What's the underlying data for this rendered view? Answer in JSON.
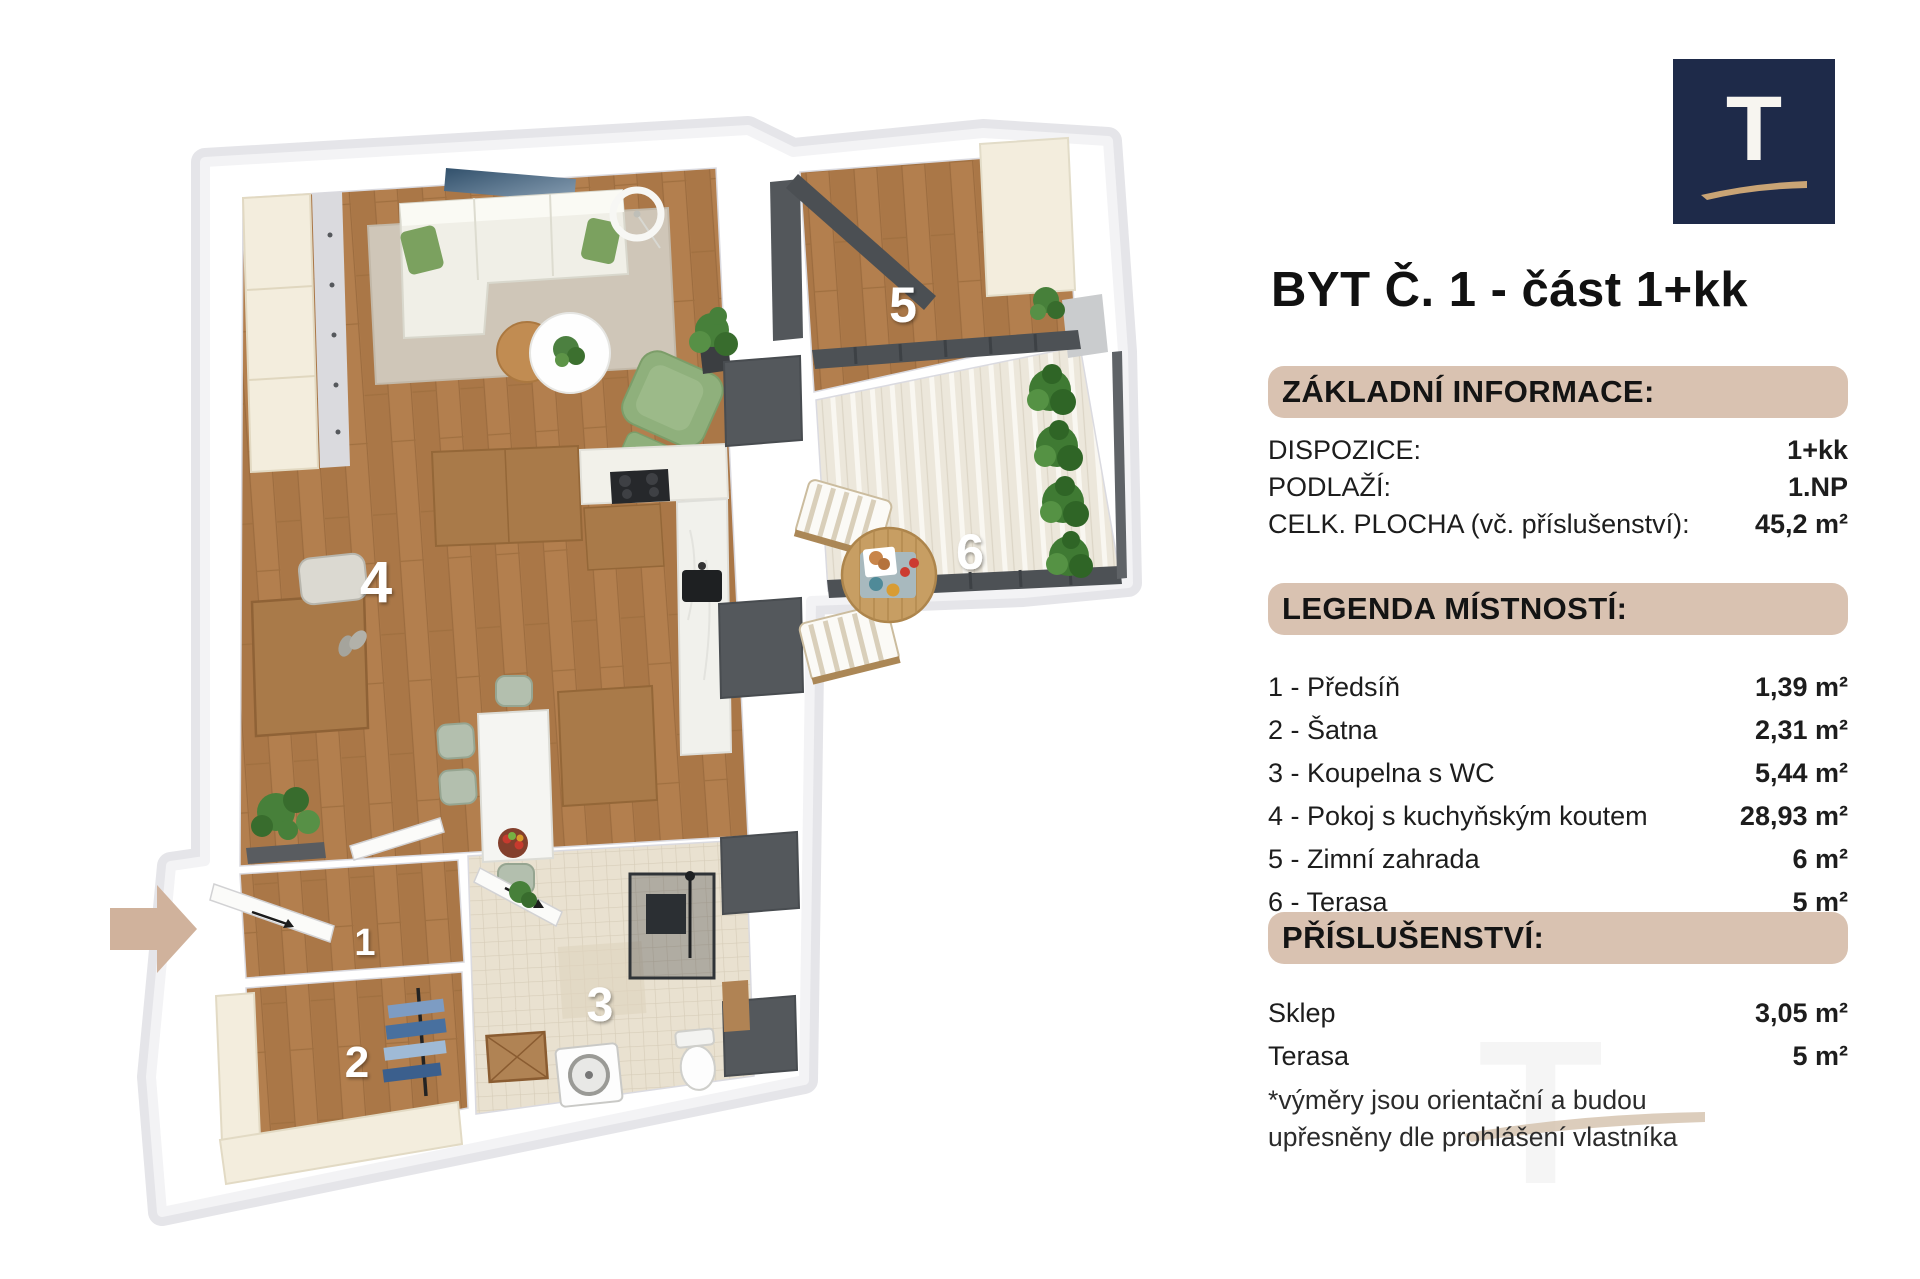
{
  "title": "BYT Č. 1 - část 1+kk",
  "logo": {
    "letter": "T"
  },
  "basic_info": {
    "heading": "ZÁKLADNÍ INFORMACE:",
    "rows": [
      {
        "label": "DISPOZICE:",
        "value": "1+kk"
      },
      {
        "label": "PODLAŽÍ:",
        "value": "1.NP"
      },
      {
        "label": "CELK. PLOCHA (vč. příslušenství):",
        "value": "45,2 m²"
      }
    ]
  },
  "legend": {
    "heading": "LEGENDA MÍSTNOSTÍ:",
    "rows": [
      {
        "label": "1 - Předsíň",
        "value": "1,39 m²"
      },
      {
        "label": "2 - Šatna",
        "value": "2,31 m²"
      },
      {
        "label": "3 - Koupelna s WC",
        "value": "5,44 m²"
      },
      {
        "label": "4 - Pokoj s kuchyňským koutem",
        "value": "28,93 m²"
      },
      {
        "label": "5 - Zimní zahrada",
        "value": "6 m²"
      },
      {
        "label": "6 - Terasa",
        "value": "5 m²"
      }
    ]
  },
  "accessories": {
    "heading": "PŘÍSLUŠENSTVÍ:",
    "rows": [
      {
        "label": "Sklep",
        "value": "3,05 m²"
      },
      {
        "label": "Terasa",
        "value": "5 m²"
      }
    ],
    "note_line1": "*výměry jsou orientační a budou",
    "note_line2": "upřesněny dle prohlášení vlastníka"
  },
  "plan": {
    "room_numbers": [
      "1",
      "2",
      "3",
      "4",
      "5",
      "6"
    ]
  },
  "colors": {
    "accent_bar": "#d9c2b1",
    "logo_navy": "#1e2a49",
    "logo_tan": "#c9a475",
    "entry_arrow": "#d0b29c",
    "wood_floor": "#b37f4e",
    "dark_frame": "#4d5155"
  }
}
